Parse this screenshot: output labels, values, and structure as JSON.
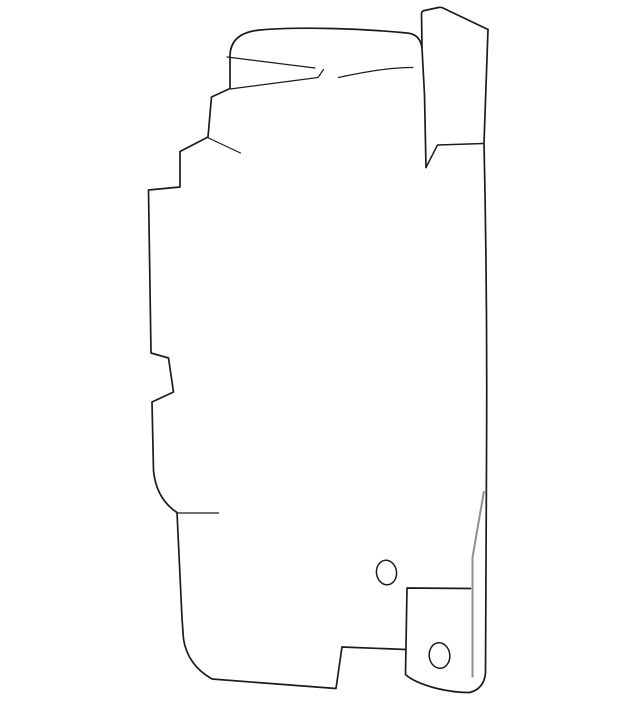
{
  "meta": {
    "description": "Technical line-art illustration of a sheet-metal automotive part: tall panel with jagged left edge, small top tab, full-height right flange, and a lower-right mounting bracket with two round holes.",
    "background_color": "#ffffff"
  },
  "drawing": {
    "canvas": {
      "width": 640,
      "height": 703
    },
    "colors": {
      "line": "#1c1c1c",
      "fold_line": "#8f8f8f",
      "background": "#ffffff"
    },
    "paths": {
      "main_outline": "M 426,167.5 L 424.5,95 L 422,48 Q 420,34 407,33 C 362,28.5 298,26.5 260,30 Q 231,32.5 230,55 L 230,88.5 L 211.5,97 L 208,137 L 180,151.5 L 180,187 L 148.5,190 L 151,353 L 168.5,358 L 173.5,392 L 152,402 L 153.5,471 Q 156.5,499 177,512.5 L 182,618 L 183.5,639 Q 187.5,665 212,679 L 336,688.5 L 342,647 L 405.5,649.5",
      "flap_notch": "M 426,167.5 L 437.5,145 L 483.5,143.5",
      "top_flap": "M 422,47 L 421.5,14 Q 421.5,11 424.5,10.5 L 438.5,7.5 Q 441.5,6.8 444,8.5 L 488,29.5",
      "right_edge": "M 488,29.5 L 484,143 Q 487.5,300 486.5,460 L 485.5,673 Q 484,689 469.5,692.5",
      "bracket": "M 470.5,588.5 L 407,588 L 405.5,674.5 Q 414,682.5 437,688.5 Q 455.5,692.8 469.5,692.5",
      "fold_line": "M 484,491 L 472.5,557.5 L 472.5,677.5",
      "crease_top_left": "M 227,57 L 315,68",
      "crease_top_mid": "M 230,89 L 318,77.5 L 323.5,69.5",
      "crease_top_right": "M 338.5,77.5 Q 387,67 413,67.5",
      "crease_step": "M 208.5,138 L 240.5,153",
      "crease_bottom_left": "M 177.5,513 L 218.5,513"
    },
    "holes": [
      {
        "name": "upper-hole",
        "cx": 386.5,
        "cy": 572.5,
        "rx": 10,
        "ry": 12.3,
        "rotate": -8
      },
      {
        "name": "lower-hole",
        "cx": 439.5,
        "cy": 655.5,
        "rx": 10.3,
        "ry": 12.8,
        "rotate": -6
      }
    ]
  }
}
